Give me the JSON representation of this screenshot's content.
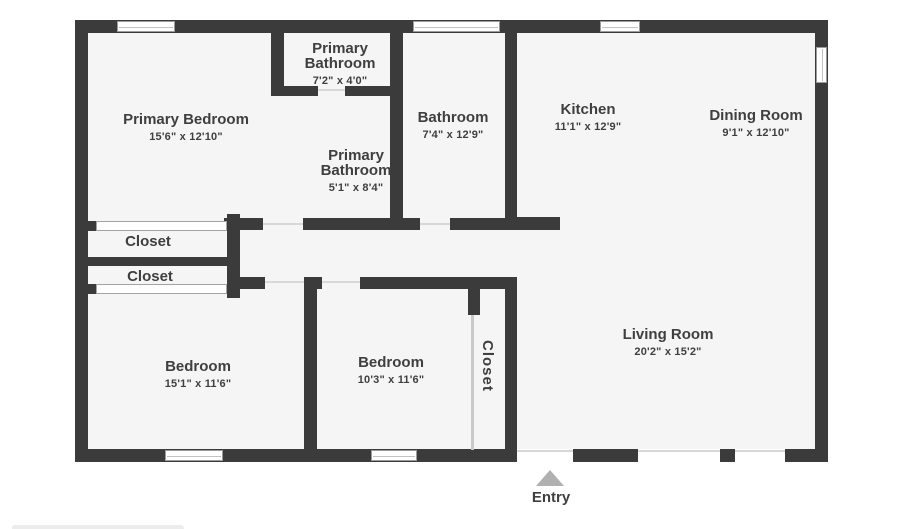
{
  "rooms": [
    {
      "id": "primary-bedroom",
      "name": "Primary Bedroom",
      "dims": "15'6\" x 12'10\""
    },
    {
      "id": "primary-bathroom-upper",
      "name": "Primary Bathroom",
      "dims": "7'2\" x 4'0\""
    },
    {
      "id": "bathroom",
      "name": "Bathroom",
      "dims": "7'4\" x 12'9\""
    },
    {
      "id": "kitchen",
      "name": "Kitchen",
      "dims": "11'1\" x 12'9\""
    },
    {
      "id": "dining-room",
      "name": "Dining Room",
      "dims": "9'1\" x 12'10\""
    },
    {
      "id": "primary-bathroom-lower",
      "name": "Primary Bathroom",
      "dims": "5'1\" x 8'4\""
    },
    {
      "id": "closet-1",
      "name": "Closet"
    },
    {
      "id": "closet-2",
      "name": "Closet"
    },
    {
      "id": "bedroom-1",
      "name": "Bedroom",
      "dims": "15'1\" x 11'6\""
    },
    {
      "id": "bedroom-2",
      "name": "Bedroom",
      "dims": "10'3\" x 11'6\""
    },
    {
      "id": "closet-bedroom2",
      "name": "Closet"
    },
    {
      "id": "living-room",
      "name": "Living Room",
      "dims": "20'2\" x 15'2\""
    }
  ],
  "entry": {
    "label": "Entry"
  },
  "colors": {
    "wall": "#3b3b3b",
    "floor": "#f5f5f5",
    "window_border": "#9b9b9b",
    "text": "#3f3f3f",
    "entry_arrow": "#b0b0b0",
    "threshold": "#d8d8d8"
  }
}
